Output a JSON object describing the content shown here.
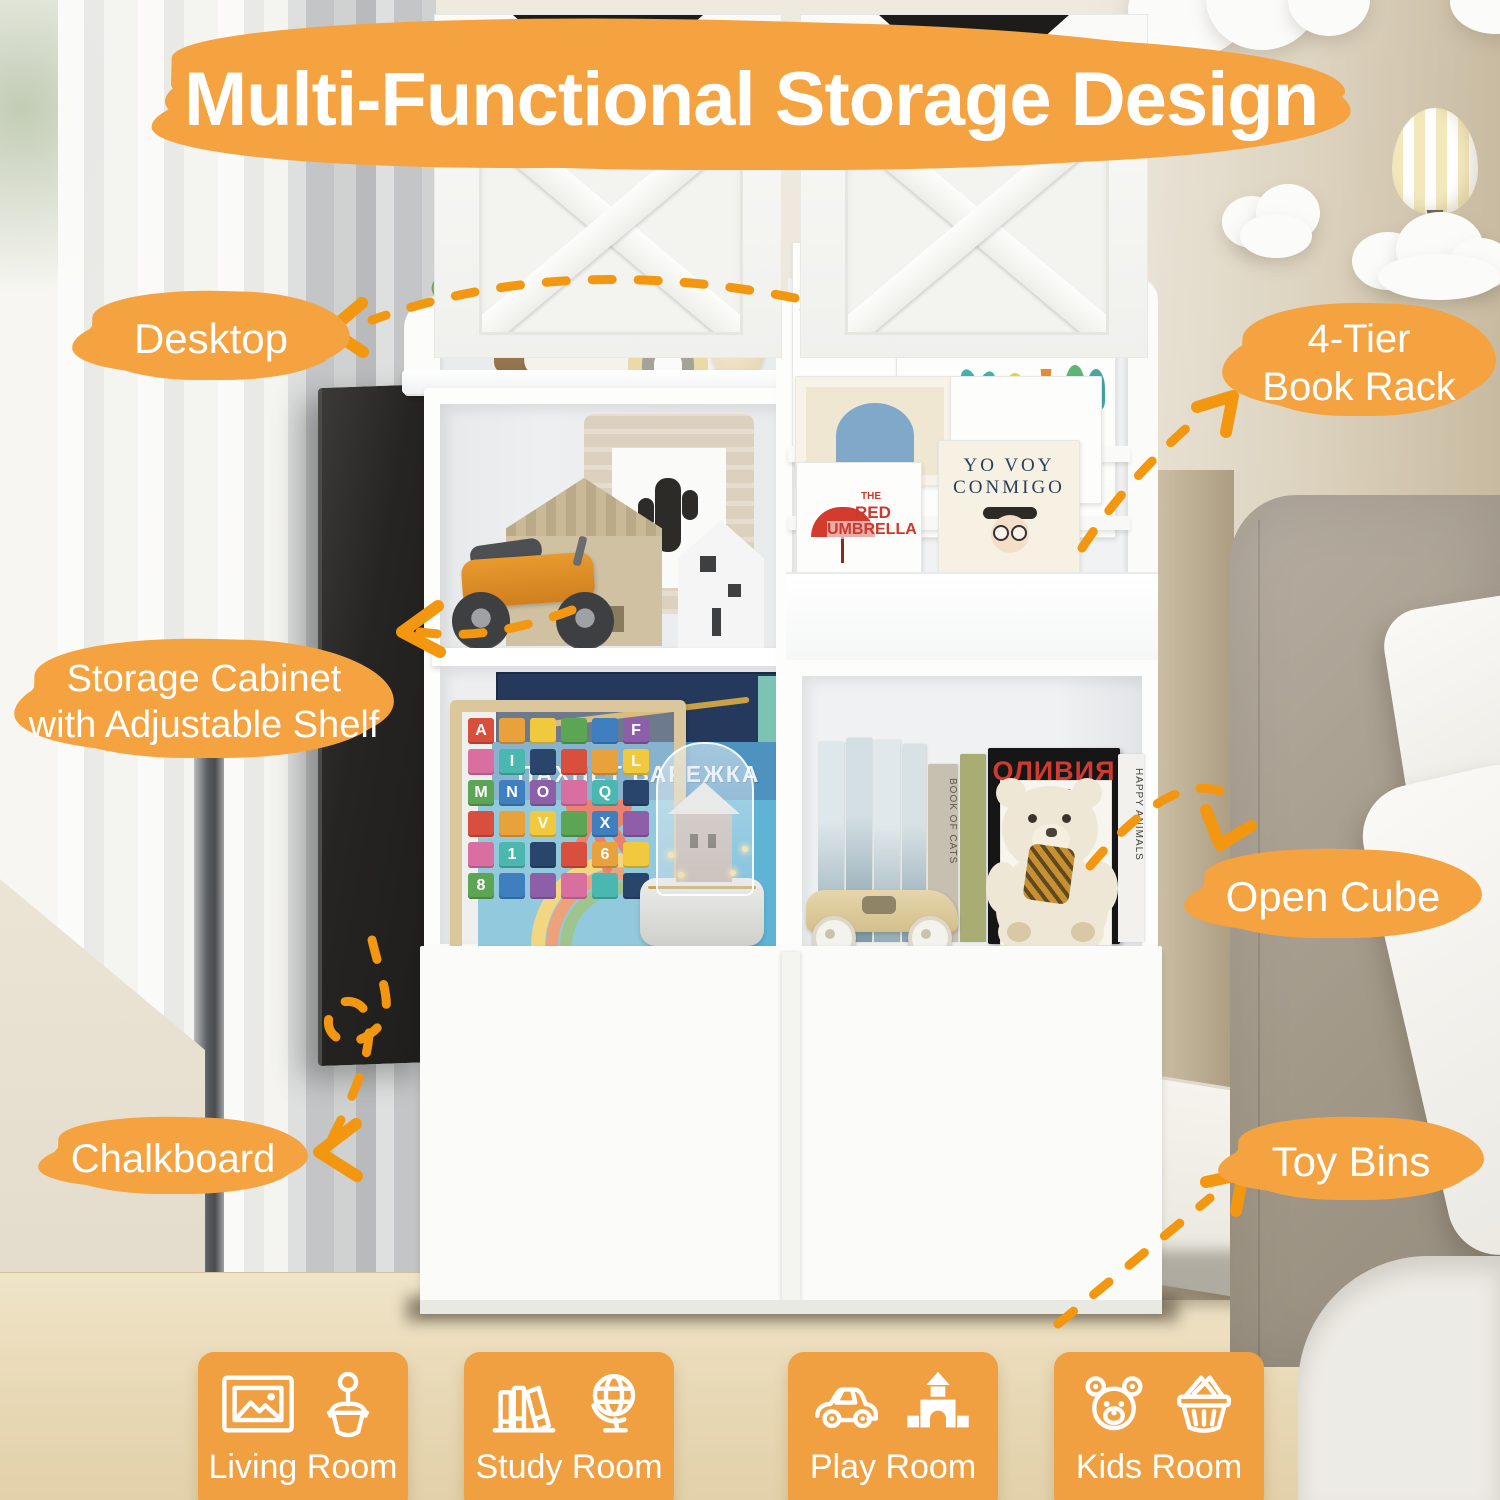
{
  "title": "Multi-Functional Storage Design",
  "colors": {
    "accent": "#F4A340",
    "arrow": "#F2970F",
    "tile": "#F0A041",
    "chalkboard": "#242321"
  },
  "callouts": {
    "desktop": "Desktop",
    "book_rack": [
      "4-Tier",
      "Book Rack"
    ],
    "storage_cabinet": [
      "Storage Cabinet",
      "with Adjustable Shelf"
    ],
    "open_cube": "Open Cube",
    "chalkboard": "Chalkboard",
    "toy_bins": "Toy Bins"
  },
  "rooms": [
    {
      "label": "Living Room",
      "icons": [
        "picture-frame-icon",
        "potted-plant-icon"
      ]
    },
    {
      "label": "Study Room",
      "icons": [
        "books-icon",
        "globe-icon"
      ]
    },
    {
      "label": "Play Room",
      "icons": [
        "toy-car-icon",
        "castle-blocks-icon"
      ]
    },
    {
      "label": "Kids Room",
      "icons": [
        "teddy-bear-icon",
        "basket-icon"
      ]
    }
  ],
  "books": {
    "jp_martin_author": "J.P. MARTIN",
    "jp_martin_credit": "Illustrated by Quentin Blake",
    "mitford_title": "Mitford",
    "mitford_subtitle": "at the fashion",
    "yo_voy_line1": "YO VOY",
    "yo_voy_line2": "CONMIGO",
    "red_umbrella_the": "THE",
    "red_umbrella_red": "RED",
    "red_umbrella_word": "UMBRELLA",
    "russian_title": "ПАХНЕТ ВАРЕЖКА",
    "olivia_title": "ОЛИВИЯ",
    "olivia_author": "Арнольд Лобел",
    "spine_cats": "BOOK OF CATS",
    "spine_dogs": "BOOK OF DOGS",
    "spine_animals": "HAPPY ANIMALS"
  },
  "alphabet_blocks": [
    "A",
    "",
    "",
    "",
    "",
    "F",
    "",
    "I",
    "",
    "",
    "",
    "L",
    "M",
    "N",
    "O",
    "",
    "Q",
    "",
    "",
    "",
    "V",
    "",
    "X",
    "",
    "",
    "1",
    "",
    "",
    "6",
    "",
    "8",
    "",
    "",
    "",
    "",
    ""
  ]
}
